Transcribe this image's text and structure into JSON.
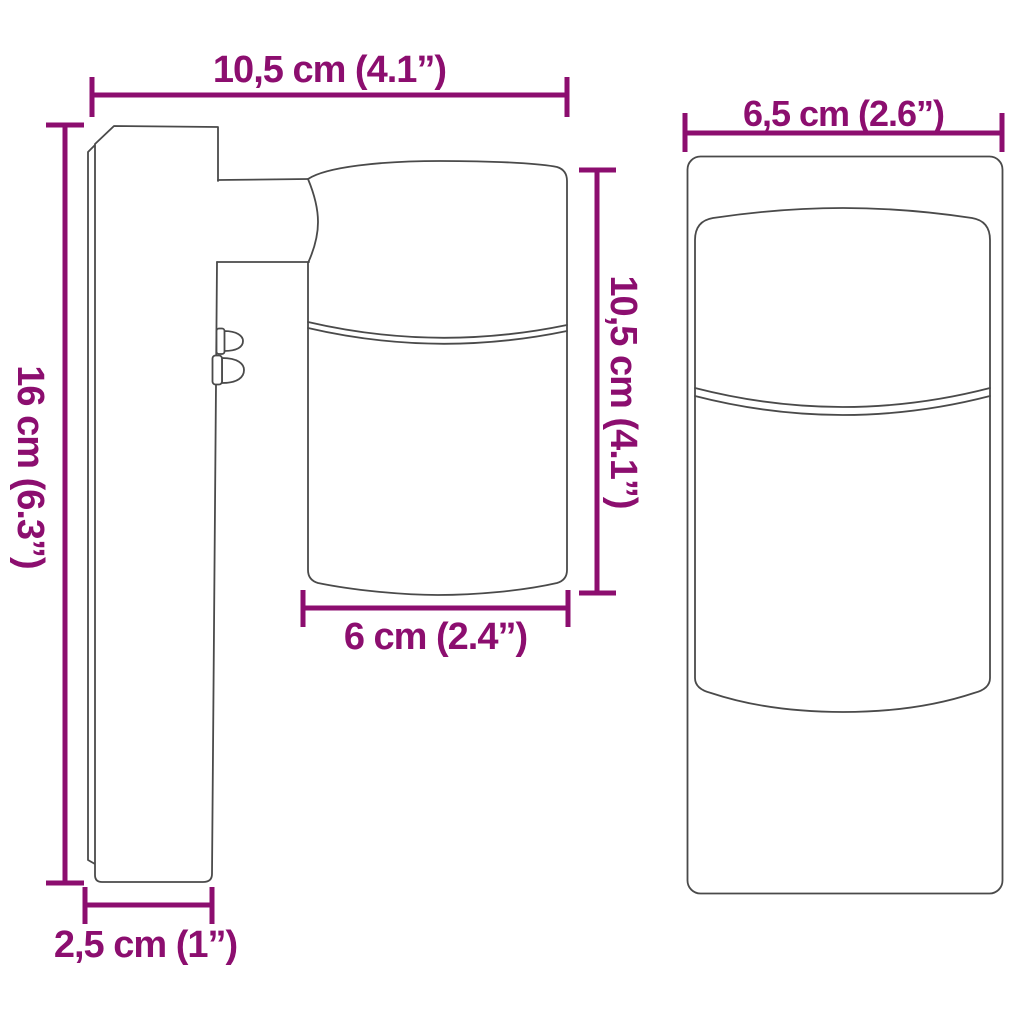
{
  "colors": {
    "dimension": "#8C0E6F",
    "outline": "#4A4A4A",
    "background": "#FFFFFF"
  },
  "side_view": {
    "overall_depth_label": "10,5 cm (4.1”)",
    "overall_height_label": "16 cm (6.3”)",
    "head_height_label": "10,5 cm (4.1”)",
    "head_diameter_label": "6 cm (2.4”)",
    "plate_depth_label": "2,5 cm (1”)"
  },
  "front_view": {
    "overall_width_label": "6,5 cm (2.6”)"
  }
}
